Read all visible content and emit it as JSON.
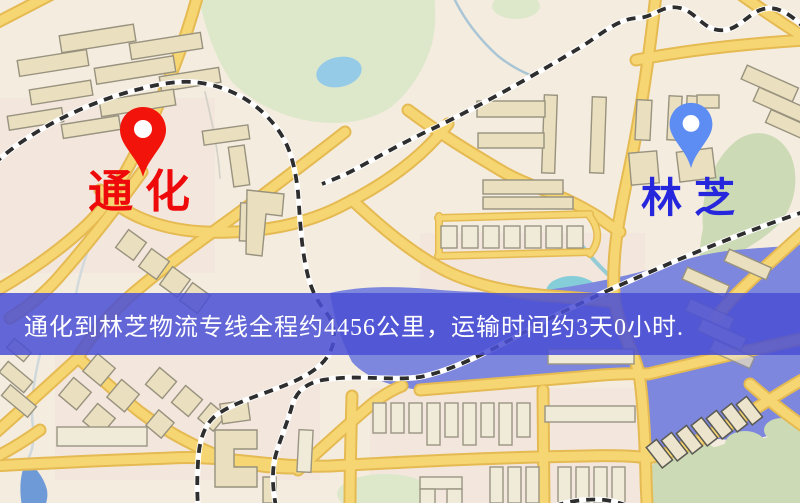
{
  "window": {
    "width": 800,
    "height": 503,
    "type": "logistics-route-map"
  },
  "map": {
    "style": "road-map",
    "palette": {
      "background": "#f4ecdf",
      "road_fill": "#f6d672",
      "road_casing": "#e5ba52",
      "lake_water": "#7d87dd",
      "pond_water": "#96cbe8",
      "corner_water": "#6f9ad8",
      "park_green": "#dde8cb",
      "hill_green": "#ccdab6",
      "building": "#eae0c0",
      "building_outline": "#98927e",
      "railway_dash": "#2e2e2e",
      "railway_base": "#ffffff"
    }
  },
  "markers": {
    "origin": {
      "label": "通化",
      "pin_color": "#f2130a",
      "label_color": "#ee0a0a",
      "pin_style": "teardrop-with-white-dot"
    },
    "destination": {
      "label": "林芝",
      "pin_color": "#5d8cf2",
      "label_color": "#2626dc",
      "pin_style": "teardrop-with-white-dot"
    }
  },
  "banner": {
    "text": "通化到林芝物流专线全程约4456公里，运输时间约3天0小时.",
    "background": "#4a4fd4",
    "text_color": "#ffffff",
    "route": {
      "origin": "通化",
      "destination": "林芝",
      "distance_text": "约4456公里",
      "duration_text": "约3天0小时"
    }
  }
}
